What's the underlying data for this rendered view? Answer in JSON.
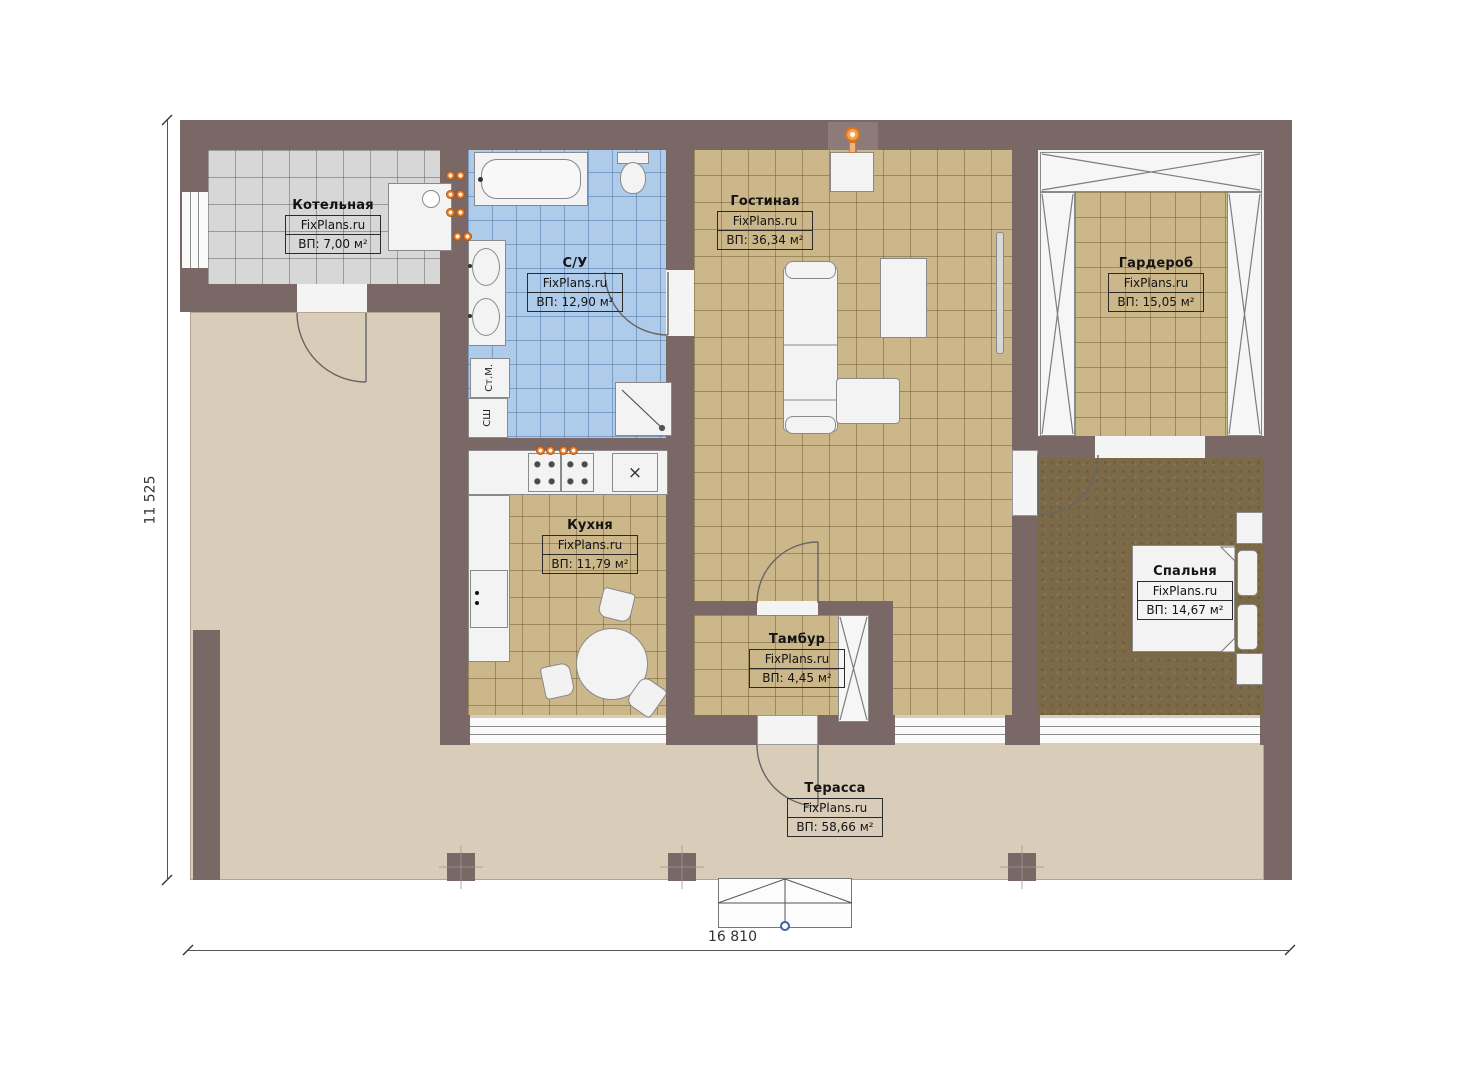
{
  "plan": {
    "watermark": "FixPlans.ru",
    "rooms": [
      {
        "name": "Котельная",
        "area_label": "ВП: 7,00 м²"
      },
      {
        "name": "С/У",
        "area_label": "ВП: 12,90 м²"
      },
      {
        "name": "Гостиная",
        "area_label": "ВП: 36,34 м²"
      },
      {
        "name": "Гардероб",
        "area_label": "ВП: 15,05 м²"
      },
      {
        "name": "Кухня",
        "area_label": "ВП: 11,79 м²"
      },
      {
        "name": "Тамбур",
        "area_label": "ВП: 4,45 м²"
      },
      {
        "name": "Спальня",
        "area_label": "ВП: 14,67 м²"
      },
      {
        "name": "Терасса",
        "area_label": "ВП: 58,66 м²"
      }
    ],
    "appliance_labels": {
      "washing_machine": "Ст.М.",
      "dryer": "СШ"
    },
    "dimensions": {
      "total_width": "16 810",
      "total_height": "11 525"
    },
    "colors": {
      "wall": "#7a6867",
      "terrace": "#d9ccb8",
      "tile_tan": "#ccb78a",
      "tile_blue": "#aecbe9",
      "tile_gray": "#d7d7d7",
      "bedroom_floor": "#7c6947",
      "accent_orange": "#e0731f"
    }
  }
}
